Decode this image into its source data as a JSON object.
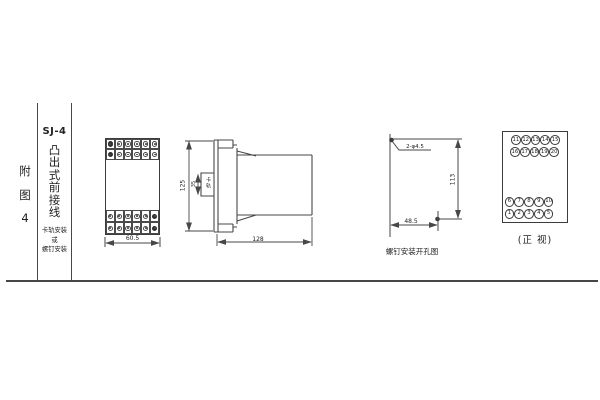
{
  "colors": {
    "line": "#474747",
    "text": "#222222",
    "background": "#ffffff"
  },
  "left_panel": {
    "figure_chars": [
      "附",
      "图",
      "4"
    ],
    "model": "SJ-4",
    "type_name_chars": [
      "凸",
      "出",
      "式",
      "前",
      "接",
      "线"
    ],
    "mounting_lines": [
      "卡轨安装",
      "或",
      "螺钉安装"
    ]
  },
  "front_view": {
    "width_dim": "60.5",
    "terminal_cols": 6,
    "terminal_rows_per_block": 2,
    "filled_top_col": 1,
    "filled_bottom_col": 6
  },
  "side_view": {
    "height_dim": "125",
    "rail_gap_dim": "35",
    "rail_label": "卡轨",
    "depth_dim": "128"
  },
  "drill_view": {
    "hole_spec": "2-φ4.5",
    "vertical_dim": "113",
    "horizontal_dim": "48.5",
    "caption": "螺钉安装开孔图"
  },
  "terminal_view": {
    "top_row_1": [
      "11",
      "12",
      "13",
      "14",
      "15"
    ],
    "top_row_2": [
      "16",
      "17",
      "18",
      "19",
      "20"
    ],
    "bottom_row_1": [
      "6",
      "7",
      "8",
      "9",
      "10"
    ],
    "bottom_row_2": [
      "1",
      "2",
      "3",
      "4",
      "5"
    ],
    "caption": "(正 视)"
  }
}
